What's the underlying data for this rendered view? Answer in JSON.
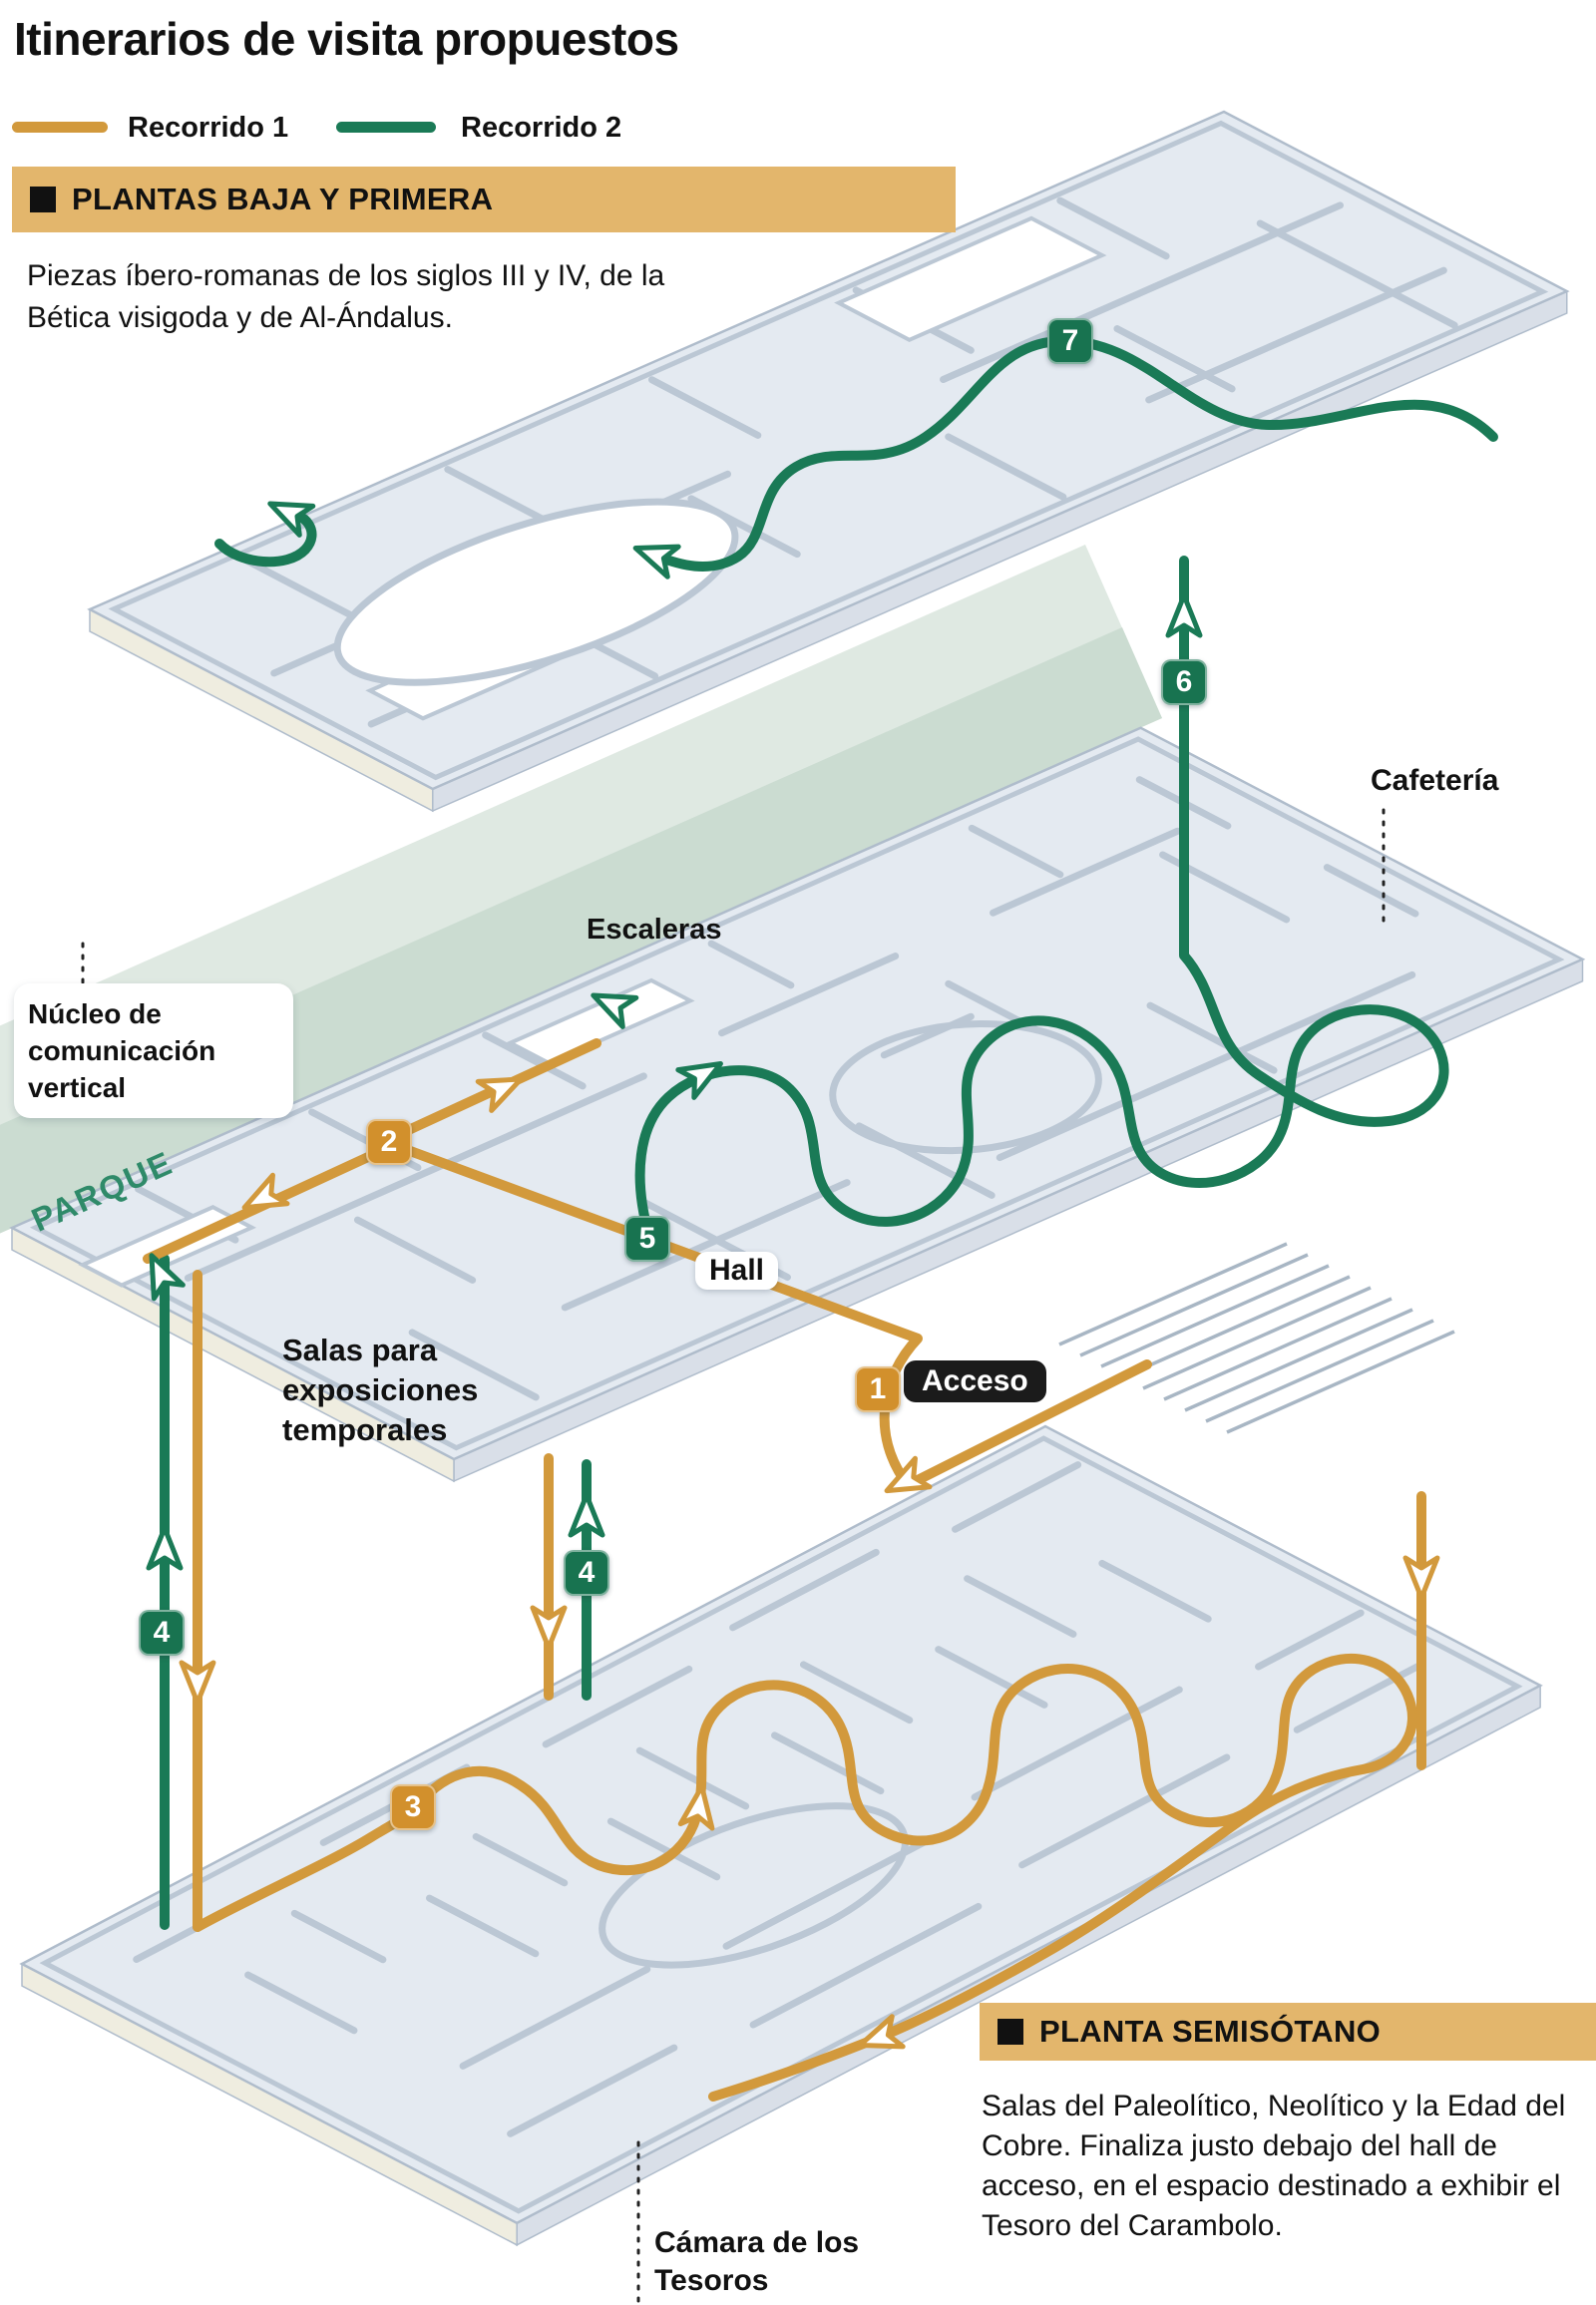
{
  "title": "Itinerarios de visita propuestos",
  "legend": {
    "route1_label": "Recorrido 1",
    "route2_label": "Recorrido 2"
  },
  "colors": {
    "route1_orange": "#D2993C",
    "route2_green": "#1A7A56",
    "section_bar_tan": "#E3B66C",
    "floor_fill": "#E4EAF1",
    "wall_gray": "#BBC7D4",
    "park_band_green": "#CBDCD1",
    "park_text_green": "#2F8A69",
    "acceso_badge_black": "#1B1B1B"
  },
  "sections": [
    {
      "title": "PLANTAS BAJA Y PRIMERA",
      "description": "Piezas íbero-romanas de los siglos III y IV, de la Bética visigoda y de Al-Ándalus."
    },
    {
      "title": "PLANTA SEMISÓTANO",
      "description": "Salas del Paleolítico, Neolítico y la Edad del Cobre. Finaliza justo debajo del hall de acceso, en el espacio destinado a exhibir el Tesoro del Carambolo."
    }
  ],
  "map_labels": {
    "cafeteria": "Cafetería",
    "escaleras": "Escaleras",
    "nucleo": "Núcleo de comunicación vertical",
    "parque": "PARQUE",
    "hall": "Hall",
    "salas_temporales": "Salas para exposiciones temporales",
    "camara_tesoros": "Cámara de los Tesoros",
    "acceso": "Acceso"
  },
  "waypoints": [
    {
      "number": "1",
      "route": "Recorrido 1",
      "label": "Acceso"
    },
    {
      "number": "2",
      "route": "Recorrido 1"
    },
    {
      "number": "3",
      "route": "Recorrido 1"
    },
    {
      "number": "4",
      "route": "Recorrido 2"
    },
    {
      "number": "4",
      "route": "Recorrido 2"
    },
    {
      "number": "5",
      "route": "Recorrido 2"
    },
    {
      "number": "6",
      "route": "Recorrido 2"
    },
    {
      "number": "7",
      "route": "Recorrido 2"
    }
  ]
}
